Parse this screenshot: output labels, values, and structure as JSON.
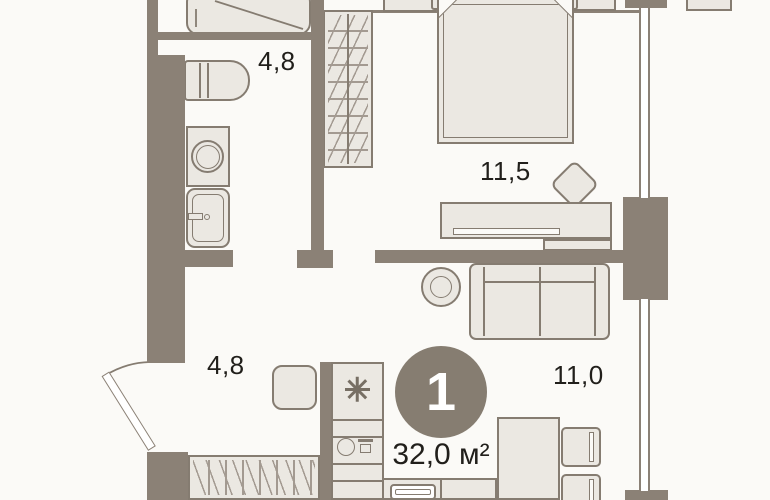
{
  "palette": {
    "bg": "#fbfaf7",
    "wall": "#8b8176",
    "furniture-fill": "#ebe8e2",
    "furniture-line": "#857c71",
    "pattern-line": "#8b8176",
    "text": "#211f1b",
    "badge-bg": "#867d71",
    "badge-text": "#ffffff"
  },
  "plan": {
    "badge": {
      "number": "1"
    },
    "area": {
      "label": "32,0 м²"
    },
    "rooms": {
      "bathroom": {
        "label": "4,8"
      },
      "bedroom": {
        "label": "11,5"
      },
      "hallway": {
        "label": "4,8"
      },
      "living": {
        "label": "11,0"
      }
    }
  }
}
